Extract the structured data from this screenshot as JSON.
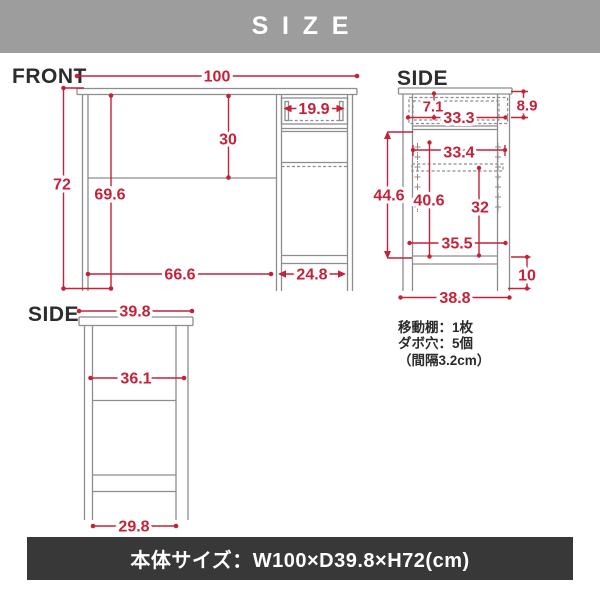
{
  "banner": {
    "title": "SIZE"
  },
  "views": {
    "front": {
      "label": "FRONT",
      "width": "100",
      "height": "72",
      "inner_height": "69.6",
      "upper_inner_height": "30",
      "drawer_width": "19.9",
      "left_bottom_span": "66.6",
      "right_bottom_span": "24.8"
    },
    "side_upper": {
      "label": "SIDE",
      "top_gap": "7.1",
      "drawer_depth": "33.3",
      "drawer_front_height": "8.9",
      "shelf_depth": "33.4",
      "inner_height": "44.6",
      "left_inner_height": "40.6",
      "door_inner_height": "32",
      "bottom_inner_depth": "35.5",
      "leg_height": "10",
      "base_depth": "38.8"
    },
    "side_lower": {
      "label": "SIDE",
      "top_depth": "39.8",
      "inner_depth": "36.1",
      "bottom_depth": "29.8"
    }
  },
  "notes": {
    "movable_shelf": "移動棚：1枚",
    "dowel_holes": "ダボ穴：5個",
    "pitch": "（間隔3.2cm）"
  },
  "footer": {
    "size_text": "本体サイズ：W100×D39.8×H72(cm)"
  },
  "colors": {
    "accent": "#c42239",
    "banner_bg": "#9d9d9d",
    "footer_bg": "#383838",
    "line_gray": "#8d8d8d"
  },
  "unit": "cm"
}
